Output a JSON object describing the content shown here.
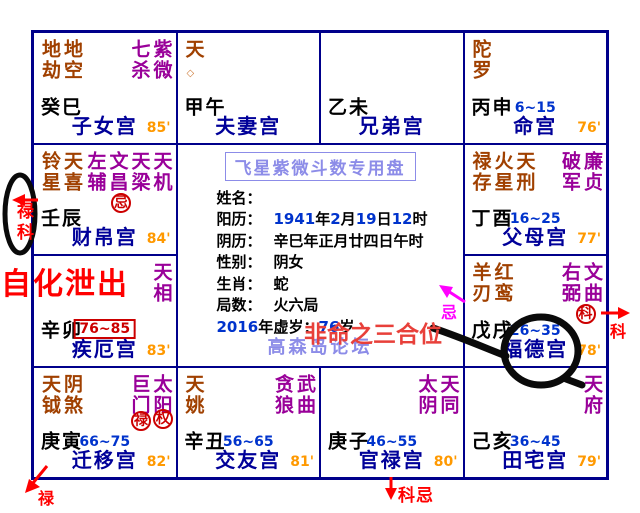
{
  "colors": {
    "grid_border": "#00008B",
    "palace_name": "#000099",
    "age_range": "#0033CC",
    "score": "#FF9900",
    "minor_star": "#A04000",
    "major_star": "#990099",
    "hua_badge": "#CC0000",
    "annotation_red": "#FF0000",
    "annotation_magenta": "#FF00FF",
    "watermark": "#8C8CE8"
  },
  "grid": {
    "palaces": [
      {
        "minor": "地劫地空",
        "major": "七杀紫微",
        "stem": "癸巳",
        "name": "子女宫",
        "score": "85'"
      },
      {
        "minor": "天",
        "minor_symbol": "◇",
        "stem": "甲午",
        "name": "夫妻宫"
      },
      {
        "stem": "乙未",
        "name": "兄弟宫"
      },
      {
        "minor": "陀罗",
        "stem": "丙申",
        "range": "6~15",
        "name": "命宫",
        "score": "76'"
      },
      {
        "minor": "铃星天喜",
        "major": "左辅文昌天梁天机",
        "hua": "忌",
        "stem": "壬辰",
        "name": "财帛宫",
        "score": "84'"
      },
      {
        "minor": "禄存火星天刑",
        "major": "破军廉贞",
        "stem": "丁酉",
        "range": "16~25",
        "name": "父母宫",
        "score": "77'"
      },
      {
        "major": "天相",
        "stem": "辛卯",
        "range_boxed": "76~85",
        "name": "疾厄宫",
        "score": "83'"
      },
      {
        "minor": "羊刃红鸾",
        "major": "右弼文曲",
        "hua": "科",
        "stem": "戊戌",
        "range": "26~35",
        "name": "福德宫",
        "score": "78'"
      },
      {
        "minor": "天钺阴煞",
        "major": "巨门太阳",
        "hua": "禄",
        "hua2": "权",
        "stem": "庚寅",
        "range": "66~75",
        "name": "迁移宫",
        "score": "82'"
      },
      {
        "minor": "天姚",
        "major": "贪狼武曲",
        "stem": "辛丑",
        "range": "56~65",
        "name": "交友宫",
        "score": "81'"
      },
      {
        "major": "太阴天同",
        "stem": "庚子",
        "range": "46~55",
        "name": "官禄宫",
        "score": "80'"
      },
      {
        "major": "天府",
        "stem": "己亥",
        "range": "36~45",
        "name": "田宅宫",
        "score": "79'"
      }
    ]
  },
  "center": {
    "title": "飞星紫微斗数专用盘",
    "fields": [
      {
        "label": "姓名：",
        "value": ""
      },
      {
        "label": "阳历：",
        "value": "1941年2月19日12时"
      },
      {
        "label": "阴历：",
        "value": "辛巳年正月廿四日午时"
      },
      {
        "label": "性别：",
        "value": "阴女"
      },
      {
        "label": "生肖：",
        "value": "蛇"
      },
      {
        "label": "局数：",
        "value": "火六局"
      },
      {
        "label": "2016年",
        "value": "虚岁：76岁"
      }
    ],
    "watermark": "高森岛论坛"
  },
  "annotations": {
    "circle_lu_ke": "禄科",
    "self_hua": "自化泄出",
    "sanhe": "非命之三合位",
    "ji": "忌",
    "ke": "科",
    "ke_ji": "科忌",
    "lu": "禄"
  }
}
